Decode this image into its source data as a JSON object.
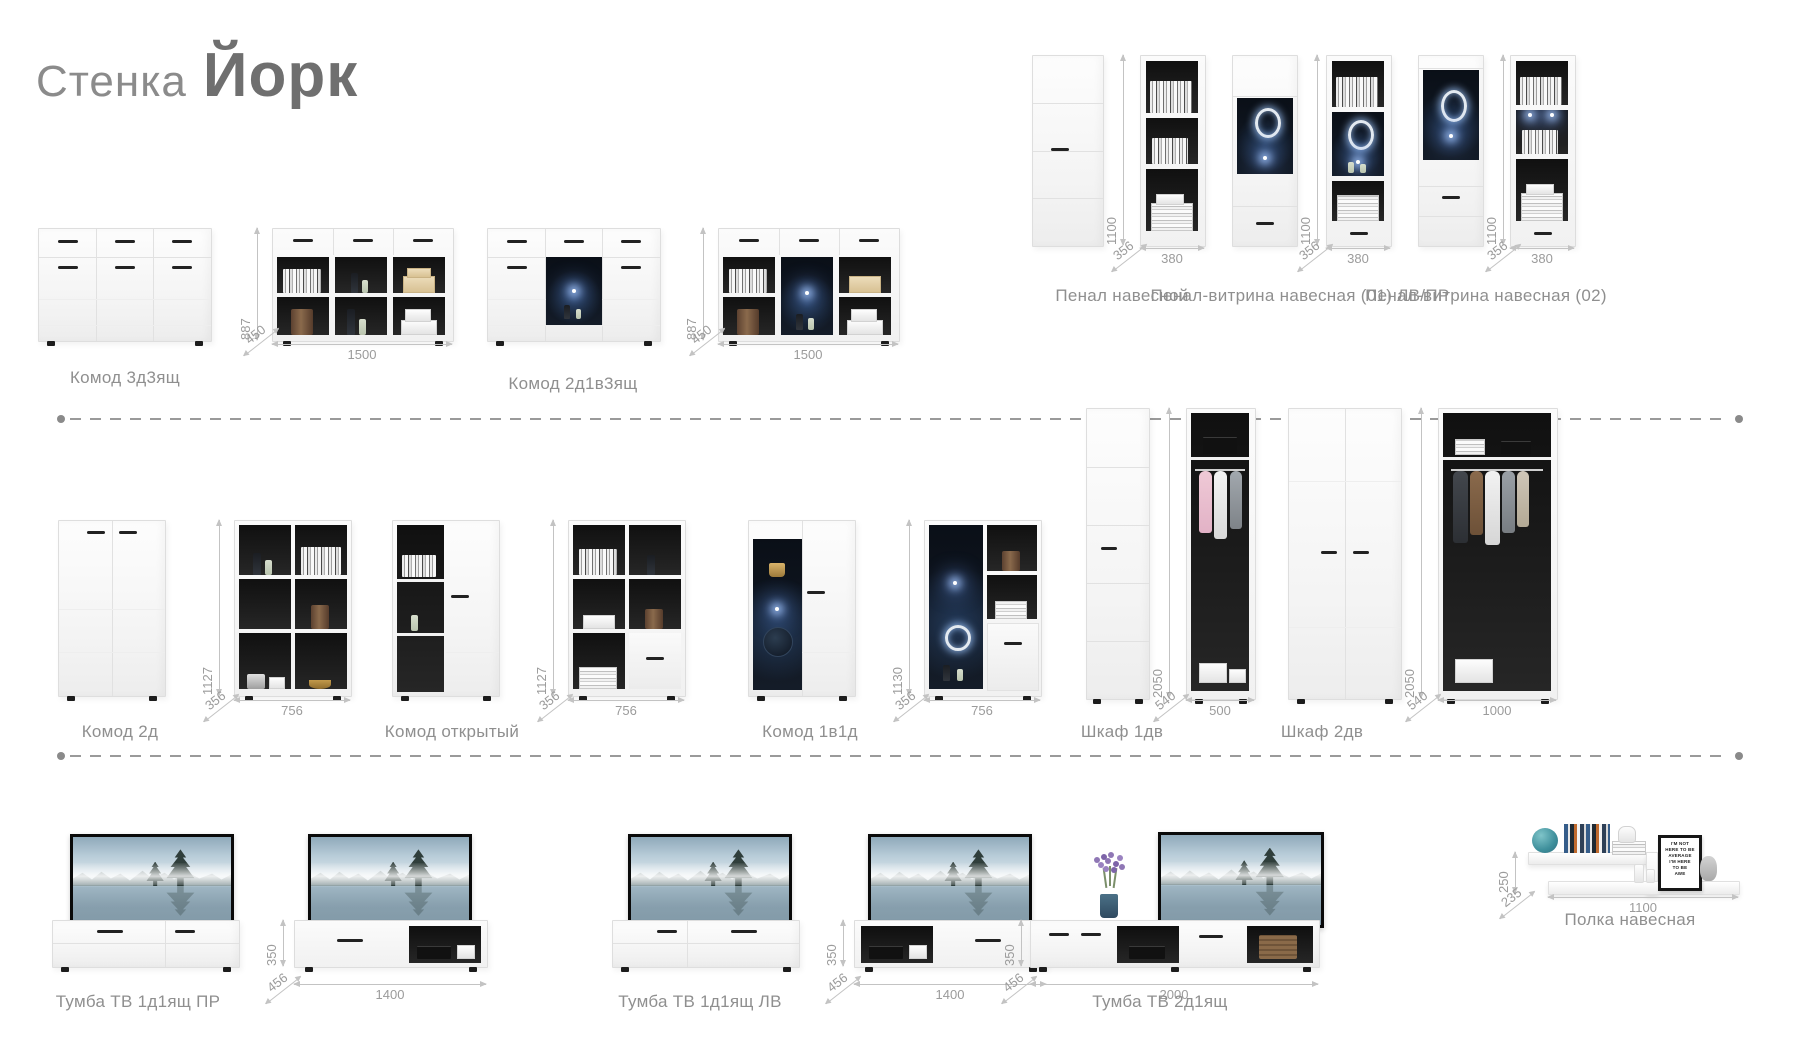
{
  "title": {
    "light": "Стенка",
    "bold": "Йорк"
  },
  "rows": {
    "row1": [
      {
        "label": "Комод 3д3ящ",
        "h": "887",
        "d": "450",
        "w": "1500"
      },
      {
        "label": "Комод 2д1в3ящ",
        "h": "887",
        "d": "450",
        "w": "1500"
      },
      {
        "label": "Пенал навесной",
        "h": "1100",
        "d": "356",
        "w": "380"
      },
      {
        "label": "Пенал-витрина навесная (01) ЛВ/ПР",
        "h": "1100",
        "d": "356",
        "w": "380"
      },
      {
        "label": "Пенал-витрина навесная (02)",
        "h": "1100",
        "d": "356",
        "w": "380"
      }
    ],
    "row2": [
      {
        "label": "Комод 2д",
        "h": "1127",
        "d": "356",
        "w": "756"
      },
      {
        "label": "Комод открытый",
        "h": "1127",
        "d": "356",
        "w": "756"
      },
      {
        "label": "Комод 1в1д",
        "h": "1130",
        "d": "356",
        "w": "756"
      },
      {
        "label": "Шкаф 1дв",
        "h": "2050",
        "d": "540",
        "w": "500"
      },
      {
        "label": "Шкаф 2дв",
        "h": "2050",
        "d": "540",
        "w": "1000"
      }
    ],
    "row3": [
      {
        "label": "Тумба ТВ 1д1ящ ПР",
        "h": "350",
        "d": "456",
        "w": "1400"
      },
      {
        "label": "Тумба ТВ 1д1ящ ЛВ",
        "h": "350",
        "d": "456",
        "w": "1400"
      },
      {
        "label": "Тумба ТВ 2д1ящ",
        "h": "350",
        "d": "456",
        "w": "2000"
      },
      {
        "label": "Полка навесная",
        "h": "250",
        "d": "235",
        "w": "1100"
      }
    ]
  },
  "poster": {
    "lines": [
      "I'M NOT",
      "HERE TO BE",
      "AVERAGE",
      "I'M HERE",
      "TO BE",
      "AWE"
    ]
  },
  "colors": {
    "label_text": "#8f8f8f",
    "dim_text": "#9b9b9b",
    "led_glow": "#9cc4ff",
    "dash": "#9a9a9a"
  }
}
